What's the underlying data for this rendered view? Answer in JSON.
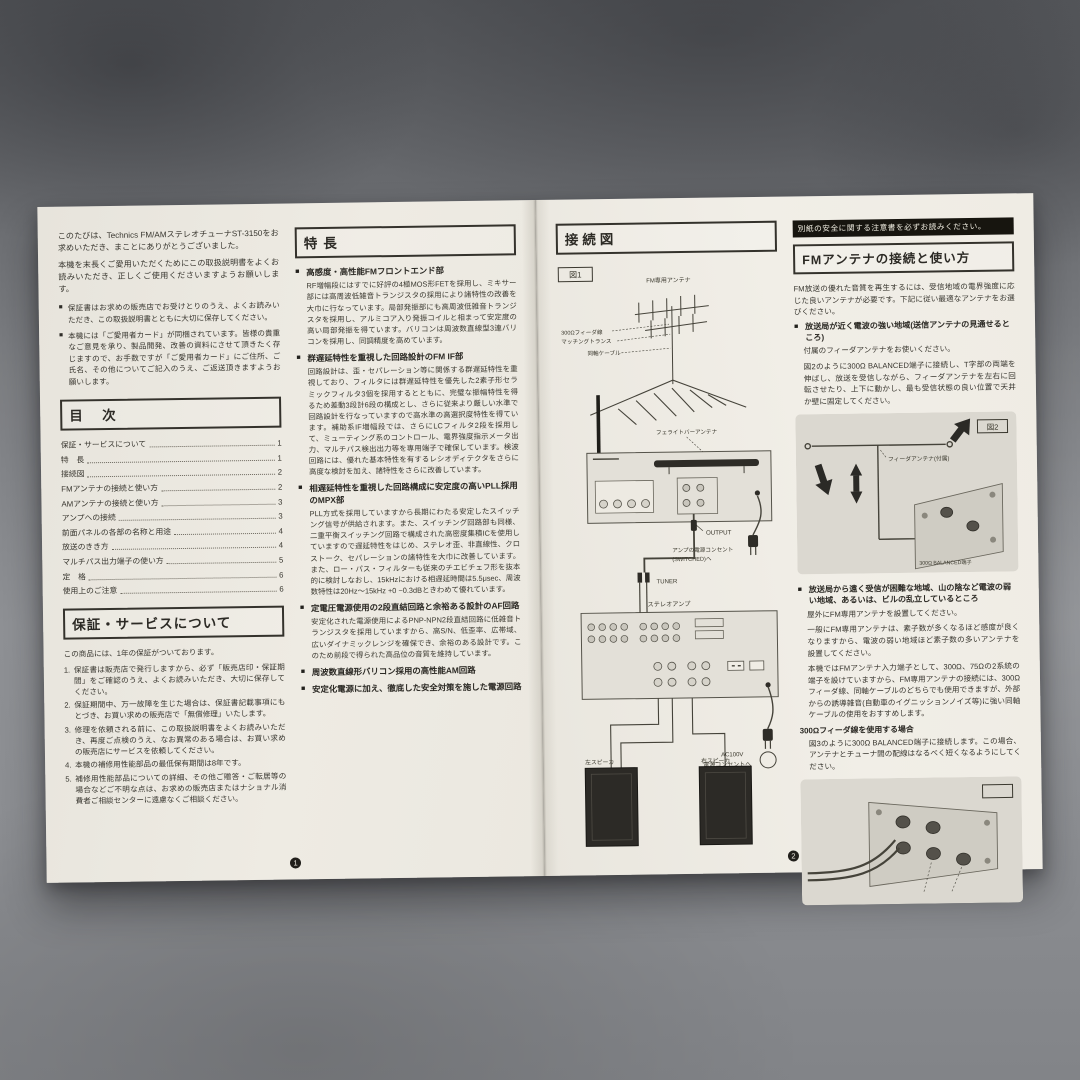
{
  "colors": {
    "paper": "#efece4",
    "ink": "#37352e",
    "banner_bg": "#17150f",
    "concrete": "#85878b",
    "diagram_panel": "#dcd9d1"
  },
  "page_markers": {
    "left": "1",
    "right": "2"
  },
  "left_page": {
    "intro": {
      "p1": "このたびは、Technics FM/AMステレオチューナST-3150をお求めいただき、まことにありがとうございました。",
      "p2": "本機を末長くご愛用いただくためにこの取扱説明書をよくお読みいただき、正しくご使用くださいますようお願いします。",
      "bullets": [
        "保証書はお求めの販売店でお受けとりのうえ、よくお読みいただき、この取扱説明書とともに大切に保存してください。",
        "本機には「ご愛用者カード」が同梱されています。皆様の貴重なご意見を承り、製品開発、改善の資料にさせて頂きたく存じますので、お手数ですが「ご愛用者カード」にご住所、ご氏名、その他についてご記入のうえ、ご返送頂きますようお願いします。"
      ]
    },
    "toc": {
      "title": "目　次",
      "items": [
        {
          "label": "保証・サービスについて",
          "page": "1"
        },
        {
          "label": "特　長",
          "page": "1"
        },
        {
          "label": "接続図",
          "page": "2"
        },
        {
          "label": "FMアンテナの接続と使い方",
          "page": "2"
        },
        {
          "label": "AMアンテナの接続と使い方",
          "page": "3"
        },
        {
          "label": "アンプへの接続",
          "page": "3"
        },
        {
          "label": "前面パネルの各部の名称と用途",
          "page": "4"
        },
        {
          "label": "放送のきき方",
          "page": "4"
        },
        {
          "label": "マルチパス出力端子の使い方",
          "page": "5"
        },
        {
          "label": "定　格",
          "page": "6"
        },
        {
          "label": "使用上のご注意",
          "page": "6"
        }
      ]
    },
    "warranty": {
      "title": "保証・サービスについて",
      "intro": "この商品には、1年の保証がついております。",
      "items": [
        {
          "num": "1.",
          "text": "保証書は販売店で発行しますから、必ず「販売店印・保証期間」をご確認のうえ、よくお読みいただき、大切に保存してください。"
        },
        {
          "num": "2.",
          "text": "保証期間中、万一故障を生じた場合は、保証書記載事項にもとづき、お買い求めの販売店で「無償修理」いたします。"
        },
        {
          "num": "3.",
          "text": "修理を依頼される前に、この取扱説明書をよくお読みいただき、再度ご点検のうえ、なお異常のある場合は、お買い求めの販売店にサービスを依頼してください。"
        },
        {
          "num": "4.",
          "text": "本機の補修用性能部品の最低保有期間は8年です。"
        },
        {
          "num": "5.",
          "text": "補修用性能部品についての詳細、その他ご贈答・ご転居等の場合などご不明な点は、お求めの販売店またはナショナル消費者ご相談センターに遠慮なくご相談ください。"
        }
      ]
    },
    "features": {
      "title": "特長",
      "sections": [
        {
          "heading": "高感度・高性能FMフロントエンド部",
          "body": "RF増幅段にはすでに好評の4極MOS形FETを採用し、ミキサー部には高周波低雑音トランジスタの採用により諸特性の改善を大巾に行なっています。局部発振部にも高周波低雑音トランジスタを採用し、アルミコア入り発振コイルと相まって安定度の高い局部発振を得ています。バリコンは周波数直線型3連バリコンを採用し、同調精度を高めています。"
        },
        {
          "heading": "群遅延特性を重視した回路設計のFM IF部",
          "body": "回路設計は、歪・セパレーション等に関係する群遅延特性を重視しており、フィルタには群遅延特性を優先した2素子形セラミックフィルタ3個を採用するとともに、完璧な振幅特性を得るため差動3段計6段の構成とし、さらに従来より厳しい水準で回路設計を行なっていますので高水準の高選択度特性を得ています。補助系IF増幅段では、さらにLCフィルタ2段を採用して、ミューティング系のコントロール、電界強度指示メータ出力、マルチパス検出出力等を専用端子で確保しています。検波回路には、優れた基本特性を有するレシオディテクタをさらに高度な検討を加え、諸特性をさらに改善しています。"
        },
        {
          "heading": "相遅延特性を重視した回路構成に安定度の高いPLL採用のMPX部",
          "body": "PLL方式を採用していますから長期にわたる安定したスイッチング信号が供給されます。また、スイッチング回路部も同様、二重平衡スイッチング回路で構成された高密度集積ICを使用していますので遅延特性をはじめ、ステレオ歪、非直線性、クロストーク、セパレーションの諸特性を大巾に改善しています。また、ロー・パス・フィルターも従来のチエビチェフ形を抜本的に検討しなおし、15kHzにおける相遅延時間は5.5μsec、周波数特性は20Hz〜15kHz +0 −0.3dBときわめて優れています。"
        },
        {
          "heading": "定電圧電源使用の2段直結回路と余裕ある設計のAF回路",
          "body": "安定化された電源使用によるPNP-NPN2段直結回路に低雑音トランジスタを採用していますから、高S/N、低歪率、広帯域、広いダイナミックレンジを確保でき、余裕のある設計です。このため前段で得られた高品位の音質を維持しています。"
        },
        {
          "heading": "周波数直線形バリコン採用の高性能AM回路",
          "body": ""
        },
        {
          "heading": "安定化電源に加え、徹底した安全対策を施した電源回路",
          "body": ""
        }
      ]
    }
  },
  "right_page": {
    "connection": {
      "title": "接続図",
      "fig1": {
        "label": "図1",
        "ant": "FM専用アンテナ",
        "feeder": "300Ωフィーダ線",
        "matching": "マッチングトランス",
        "coax": "同軸ケーブル",
        "t75": "75Ω端子",
        "ferrite": "フェライトバーアンテナ",
        "output": "OUTPUT",
        "ac_sw1": "アンプの電源コンセント",
        "ac_sw2": "(SWITCHED)へ",
        "tuner_jack": "TUNER",
        "amp": "ステレオアンプ",
        "ac1": "AC100V",
        "ac2": "電源コンセントへ",
        "sp_left": "左スピーカ",
        "sp_right": "右スピーカ"
      }
    },
    "fm": {
      "banner": "別紙の安全に関する注意書を必ずお読みください。",
      "title": "FMアンテナの接続と使い方",
      "p1": "FM放送の優れた音質を再生するには、受信地域の電界強度に応じた良いアンテナが必要です。下記に従い最適なアンテナをお選びください。",
      "h1": "放送局が近く電波の強い地域(送信アンテナの見通せるところ)",
      "p2": "付属のフィーダアンテナをお使いください。",
      "p3": "図2のように300Ω BALANCED端子に接続し、T字部の両端を伸ばし、放送を受信しながら、フィーダアンテナを左右に回転させたり、上下に動かし、最も受信状態の良い位置で天井か壁に固定してください。",
      "fig2": {
        "label": "図2",
        "feeder": "フィーダアンテナ(付属)",
        "bal": "300Ω BALANCED端子"
      },
      "h2": "放送局から遠く受信が困難な地域、山の陰など電波の弱い地域、あるいは、ビルの乱立しているところ",
      "p4": "屋外にFM専用アンテナを設置してください。",
      "p5": "一般にFM専用アンテナは、素子数が多くなるほど感度が良くなりますから、電波の弱い地域ほど素子数の多いアンテナを設置してください。",
      "p6": "本機ではFMアンテナ入力端子として、300Ω、75Ωの2系統の端子を設けていますから、FM専用アンテナの接続には、300Ωフィーダ線、同軸ケーブルのどちらでも使用できますが、外部からの誘導雑音(自動車のイグニッションノイズ等)に強い同軸ケーブルの使用をおすすめします。",
      "h3": "300Ωフィーダ線を使用する場合",
      "p7": "図3のように300Ω BALANCED端子に接続します。この場合、アンテナとチューナ間の配線はなるべく短くなるようにしてください。"
    }
  }
}
